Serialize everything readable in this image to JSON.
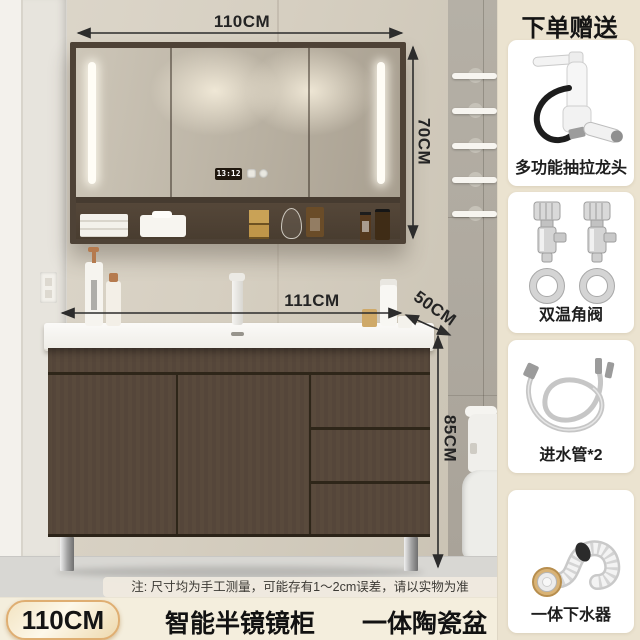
{
  "scene": {
    "mirror_clock": "13:12",
    "dim_top": "110CM",
    "dim_mirror_height": "70CM",
    "dim_counter_width": "111CM",
    "dim_counter_depth": "50CM",
    "dim_cabinet_height": "85CM",
    "note": "注: 尺寸均为手工测量，可能存有1～2cm误差，请以实物为准"
  },
  "sidebar": {
    "title": "下单赠送",
    "items": [
      {
        "name": "pullout-faucet",
        "label": "多功能抽拉龙头"
      },
      {
        "name": "angle-valves",
        "label": "双温角阀"
      },
      {
        "name": "inlet-hoses",
        "label": "进水管*2"
      },
      {
        "name": "drain-kit",
        "label": "一体下水器"
      }
    ]
  },
  "footer": {
    "size_badge": "110CM",
    "features": [
      "智能半镜镜柜",
      "一体陶瓷盆"
    ]
  },
  "colors": {
    "sidebar_bg": "#ebe3d0",
    "footer_bg": "#f4eedd",
    "badge_border": "#dfae72",
    "annotation_text": "#242424",
    "cabinet_wood": "#574839",
    "wall_beige": "#d6cfc1"
  }
}
